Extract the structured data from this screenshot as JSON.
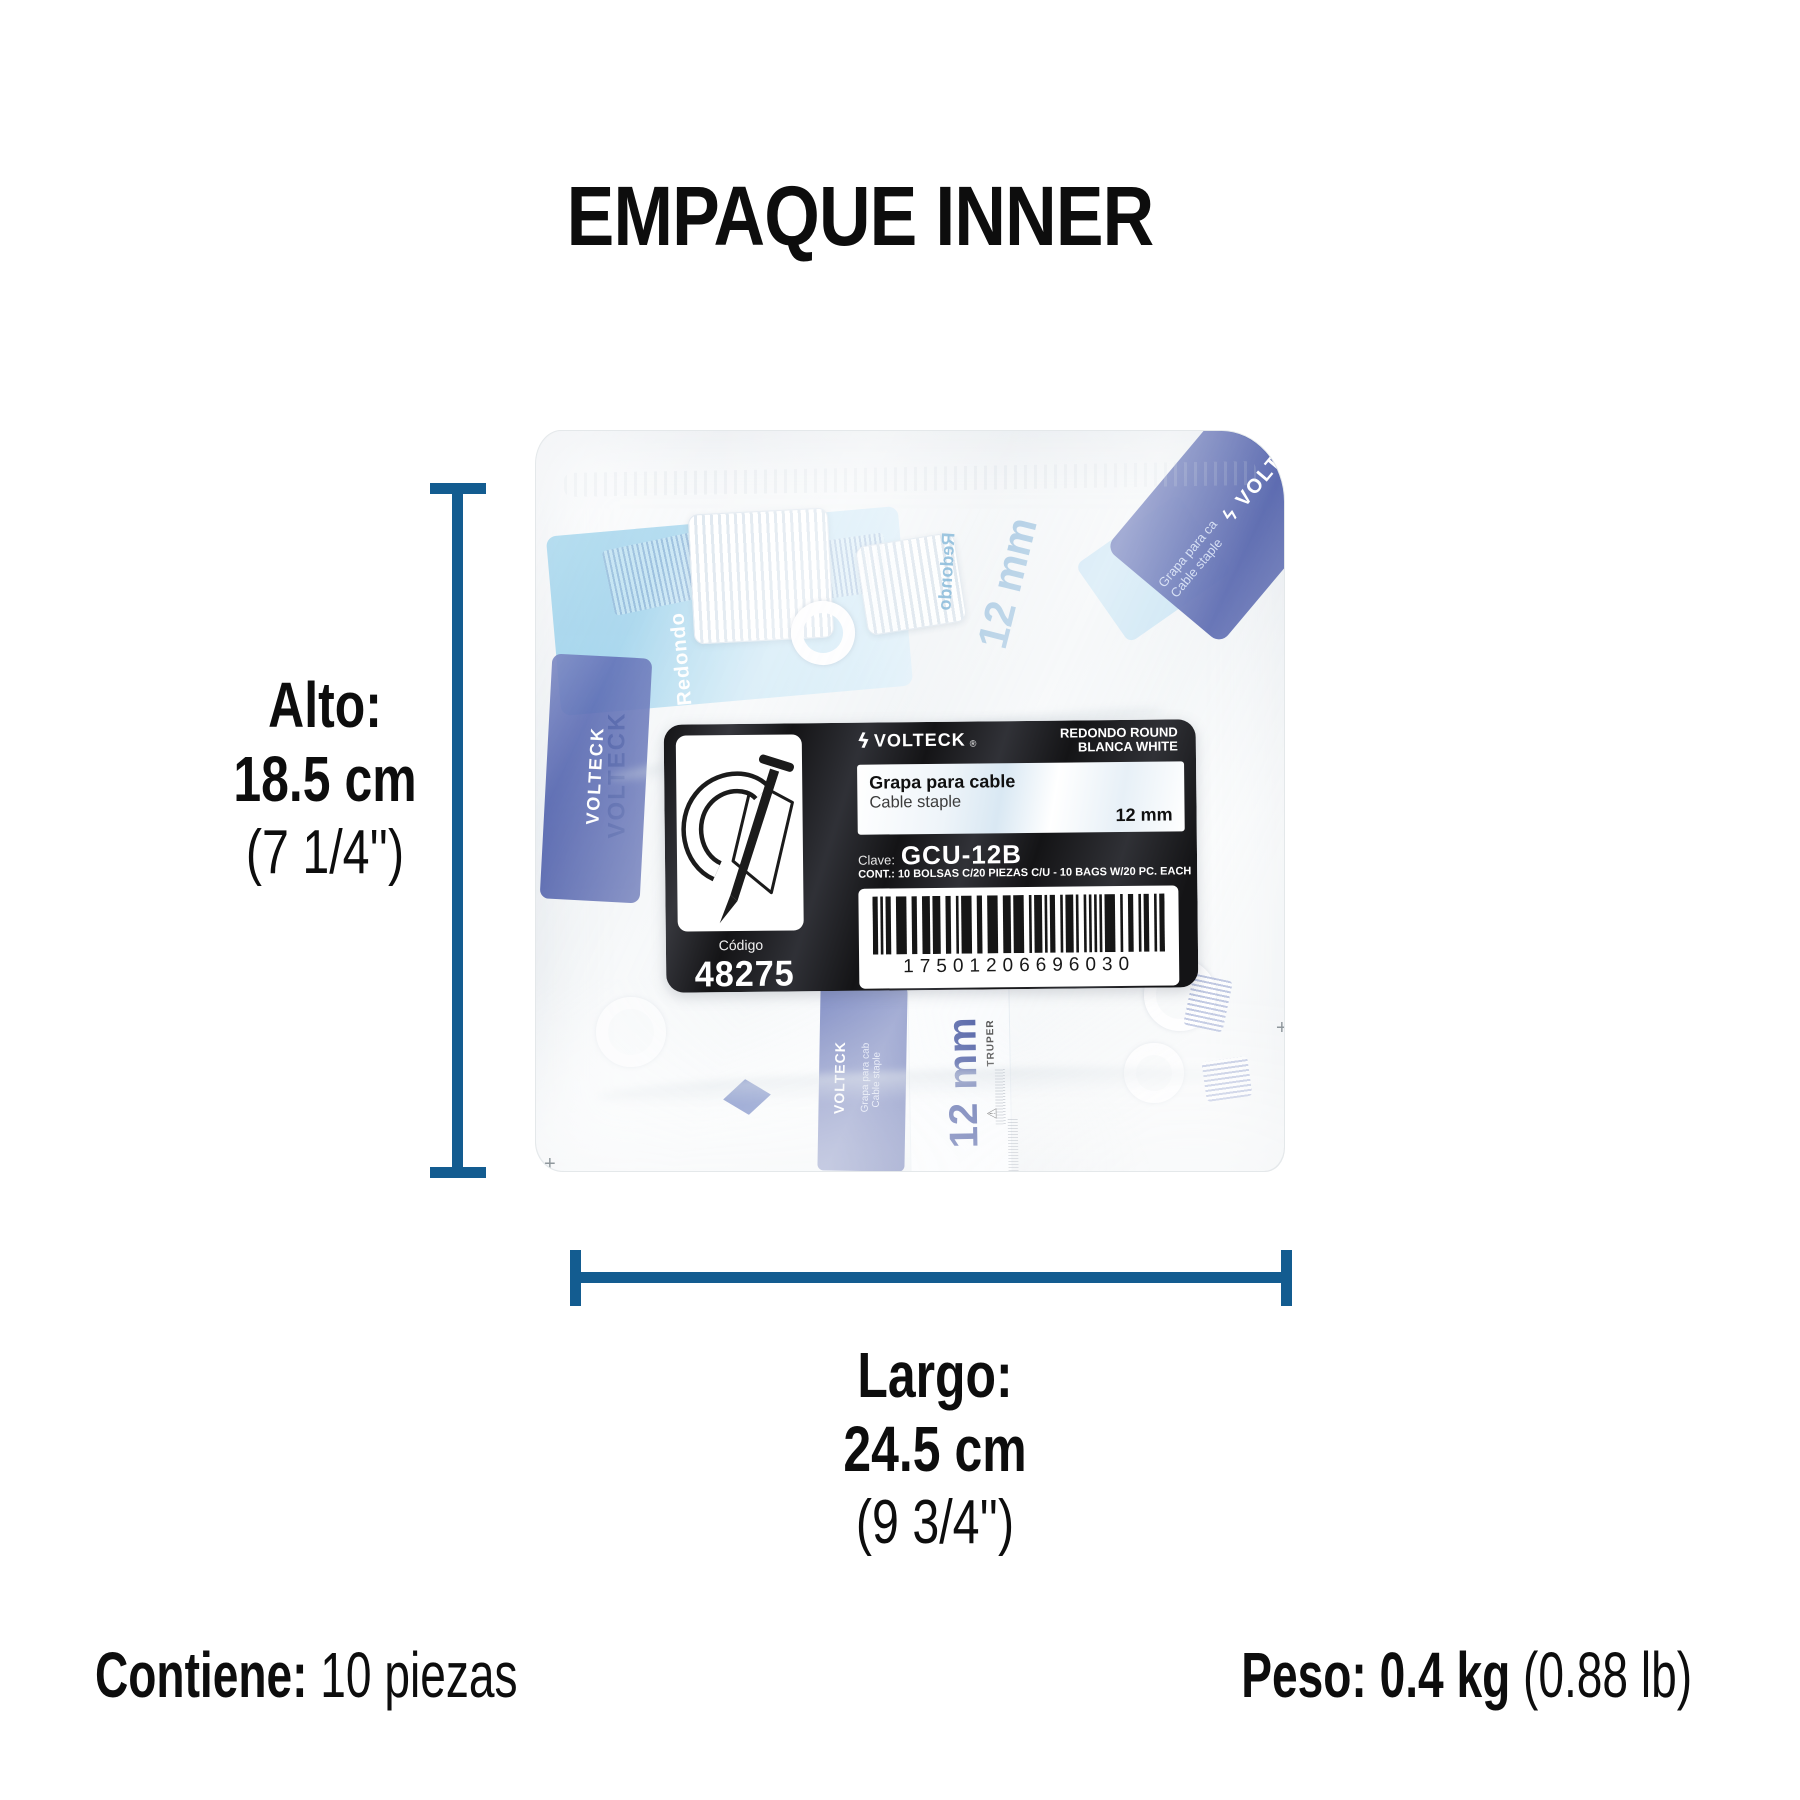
{
  "page": {
    "title": "EMPAQUE INNER"
  },
  "colors": {
    "dimension_line": "#135c90",
    "text": "#0d0d0d",
    "label_bg": "#141416",
    "inner_blue": "#4a5cab",
    "inner_light_blue": "#9fd0ea",
    "staple_size_text": "#2b3f92"
  },
  "icons": {
    "volteck_logo": "ϟ",
    "warning": "⚠",
    "registration_mark": "+"
  },
  "dimensions": {
    "alto": {
      "label": "Alto:",
      "metric": "18.5 cm",
      "imperial": "(7 1/4'')"
    },
    "largo": {
      "label": "Largo:",
      "metric": "24.5 cm",
      "imperial": "(9 3/4'')"
    }
  },
  "footer": {
    "contains_label": "Contiene:",
    "contains_value": " 10 piezas",
    "weight_label": "Peso: 0.4 kg ",
    "weight_imperial": "(0.88 lb)"
  },
  "label": {
    "brand": "VOLTECK",
    "registered": "®",
    "variant_line1": "REDONDO ROUND",
    "variant_line2": "BLANCA WHITE",
    "product_es": "Grapa para cable",
    "product_en": "Cable staple",
    "size": "12 mm",
    "clave_label": "Clave:",
    "clave_value": "GCU-12B",
    "contents_line": "CONT.:  10 BOLSAS C/20 PIEZAS C/U - 10 BAGS W/20 PC. EACH",
    "codigo_label": "Código",
    "codigo_value": "48275",
    "barcode_value": "17501206696030"
  },
  "bag_contents": {
    "redondo_fragment": "Redondo",
    "brand_fragment": "VOLTECK",
    "grapa_fragment": "Grapa para ca",
    "staple_fragment": "Cable staple",
    "size_fragment": "12 mm",
    "grapa_small_fragment": "Grapa para cab",
    "staple_small_fragment": "Cable staple",
    "size_small_fragment": "12 mm",
    "truper_fragment": "TRUPER"
  }
}
